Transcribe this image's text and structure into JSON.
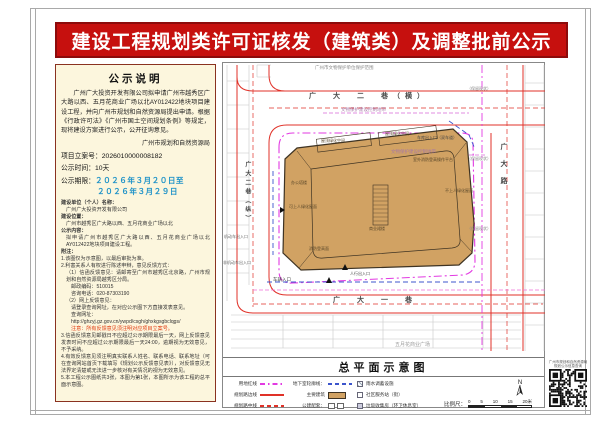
{
  "page": {
    "title": "建设工程规划类许可证核发（建筑类）及调整批前公示"
  },
  "notice": {
    "heading": "公示说明",
    "intro": "广州广大投资开发有限公司拟申请广州市越秀区广大路以西、五月花商业广场以北AY012422地块项目建设工程，并向广州市规划和自然资源局提出申请。根据《行政许可法》《广州市国土空间规划条例》等规定，现将建设方案进行公示，公开征询意见。",
    "authority": "广州市规划和自然资源局",
    "case_no_label": "项目立案号：",
    "case_no": "2026010000008182",
    "duration_label": "公示时间：",
    "duration": "10天",
    "period_label": "公示期限：",
    "period_line1": "２０２６年３月２０日至",
    "period_line2": "２０２６年３月２９日",
    "fields": [
      {
        "label": "建设单位（个人）名称：",
        "value": "广州广大投资开发有限公司"
      },
      {
        "label": "建设位置：",
        "value": "广州市越秀区广大路以西、五月花商业广场以北"
      },
      {
        "label": "公示内容：",
        "value": "拟申请广州市越秀区广大路以西、五月花商业广场以北AY012422地块项目建设工程。"
      }
    ],
    "notes_label": "附注：",
    "notes": [
      "1.该图仅为示意图，以最后审批为准。",
      "2.利害关系人有权进行陈述申辩，意见反馈方式：",
      "（1）信函反馈意见：请邮寄至广州市越秀区北京路，广州市规划和自然资源局越秀区分局。",
      "邮政编码：510015",
      "咨询电话：020-87303190",
      "（2）网上反馈意见：",
      "请登录查询网址，在对应公示图下方直接发表意见。",
      "查询网址：",
      "http://ghzyj.gz.gov.cn/ywpd/csgh/ghxkgsgbclqgs/",
      "注意：所有反馈意见须注明对应项目立案号。",
      "3.信函反馈意见邮戳日不应超过公示期限最后一天，网上反馈意见发表时间不应超过公示期限最后一天24:00，逾期视为无效意见，不予采纳。",
      "4.有效反馈意见须注明真实联系人姓名、联系电话、联系地址（可在查询网站首页下载填写《规划公示反馈意见表》），对反馈意见无法界定清楚或无法进一步核对有关情况的视为无效意见。",
      "5.本工程公示图纸共3张，本图为第1张，本图所示为该工程的总平面示意图。"
    ]
  },
  "map": {
    "roads": {
      "top": "广　大　二　巷（横）",
      "left": "广大二巷（纵）",
      "right": "广大路",
      "bottom": "广　大　一　巷"
    },
    "an": {
      "heritage": "广州市文物保护单位保护范围",
      "control1": "文物保护建设控制地带",
      "control2": "文物保护建设控制地带",
      "garage": "车库出入口（双车道）",
      "vehicle": "车辆入口",
      "motor": "机动车出入口",
      "nonmotor": "非机动车出入口",
      "walk": "人行出入口",
      "mall": "五月花商业广场",
      "keep1": "（保留现状）",
      "keep2": "（保留现状）",
      "keep3": "（保留现状）"
    },
    "bl": {
      "b1": "屋顶绿化空间",
      "b2": "屋顶绿化空间",
      "b3": "室外消防登高操作平台",
      "b4": "办公塔楼",
      "b5": "可上人绿化屋面",
      "b6": "商业裙楼",
      "b7": "消防登高面",
      "b8": "不上人绿化屋面"
    },
    "legend": {
      "title": "总平面示意图",
      "col1": [
        "用地红线",
        "规划路边线",
        "规划路中线"
      ],
      "col2": [
        "地下室轮廓线：",
        "主要建筑",
        "公建配套："
      ],
      "col3": [
        "雨水调蓄设施",
        "社区服务站（街）",
        "垃圾收集房（环卫休息室）"
      ],
      "scale_label": "比例尺：",
      "scale_ticks": [
        "0",
        "5",
        "10",
        "15",
        "20米"
      ],
      "north": "N"
    },
    "colors": {
      "boundary_magenta": "#e23ae2",
      "road_red": "#e03128",
      "basement_blue": "#3c55cc",
      "building_tan": "#d1a263"
    }
  },
  "qr": {
    "line1": "广州市规划和自然资源局",
    "line2": "规划公示信息查询"
  }
}
